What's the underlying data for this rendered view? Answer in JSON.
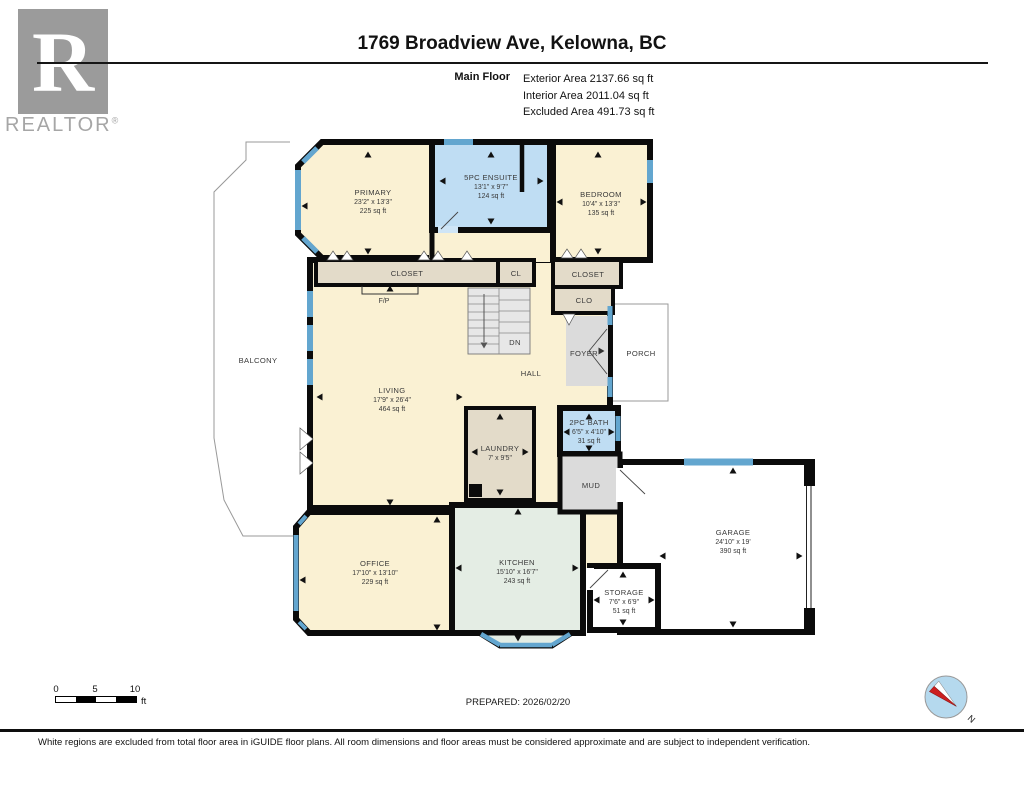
{
  "palette": {
    "room_cream": "#FAF1D3",
    "room_blue": "#BFDDF3",
    "room_tan": "#E3DBC9",
    "room_mint": "#E4EDE4",
    "room_gray": "#DBDBDB",
    "window_blue": "#63A6CF",
    "wall_black": "#0B0B0B",
    "excluded_white": "#FFFFFF",
    "compass_fill": "#B5D9EE",
    "compass_needle_red": "#CC1F1F",
    "logo_gray": "#9B9B9B"
  },
  "logo": {
    "letter": "R",
    "wordmark": "REALTOR",
    "registered": "®"
  },
  "header": {
    "title": "1769 Broadview Ave, Kelowna, BC",
    "floor_label": "Main Floor",
    "stats": [
      {
        "label": "Exterior Area",
        "value": "2137.66 sq ft"
      },
      {
        "label": "Interior Area",
        "value": "2011.04 sq ft"
      },
      {
        "label": "Excluded Area",
        "value": "491.73 sq ft"
      }
    ]
  },
  "rooms": {
    "primary": {
      "name": "PRIMARY",
      "dims": "23'2\" x 13'3\"",
      "area": "225 sq ft"
    },
    "ensuite": {
      "name": "5PC ENSUITE",
      "dims": "13'1\" x 9'7\"",
      "area": "124 sq ft"
    },
    "bedroom": {
      "name": "BEDROOM",
      "dims": "10'4\" x 13'3\"",
      "area": "135 sq ft"
    },
    "living": {
      "name": "LIVING",
      "dims": "17'9\" x 26'4\"",
      "area": "464 sq ft"
    },
    "office": {
      "name": "OFFICE",
      "dims": "17'10\" x 13'10\"",
      "area": "229 sq ft"
    },
    "kitchen": {
      "name": "KITCHEN",
      "dims": "15'10\" x 16'7\"",
      "area": "243 sq ft"
    },
    "garage": {
      "name": "GARAGE",
      "dims": "24'10\" x 19'",
      "area": "390 sq ft"
    },
    "storage": {
      "name": "STORAGE",
      "dims": "7'6\" x 6'9\"",
      "area": "51 sq ft"
    },
    "laundry": {
      "name": "LAUNDRY",
      "dims": "7' x 9'5\""
    },
    "bath": {
      "name": "2PC BATH",
      "dims": "6'5\" x 4'10\"",
      "area": "31 sq ft"
    },
    "mud": {
      "name": "MUD"
    },
    "foyer": {
      "name": "FOYER"
    },
    "porch": {
      "name": "PORCH"
    },
    "hall": {
      "name": "HALL"
    },
    "balcony": {
      "name": "BALCONY"
    },
    "closet_primary": {
      "name": "CLOSET"
    },
    "closet_cl": {
      "name": "CL"
    },
    "closet_bedroom": {
      "name": "CLOSET"
    },
    "closet_clo": {
      "name": "CLO"
    },
    "fireplace": {
      "label": "F/P"
    },
    "stairs": {
      "label": "DN"
    }
  },
  "footer": {
    "prepared": "PREPARED: 2026/02/20",
    "disclaimer": "White regions are excluded from total floor area in iGUIDE floor plans. All room dimensions and floor areas must be considered approximate and are subject to independent verification.",
    "scale": {
      "tick0": "0",
      "tick5": "5",
      "tick10": "10",
      "unit": "ft"
    },
    "compass": {
      "north": "N"
    }
  }
}
